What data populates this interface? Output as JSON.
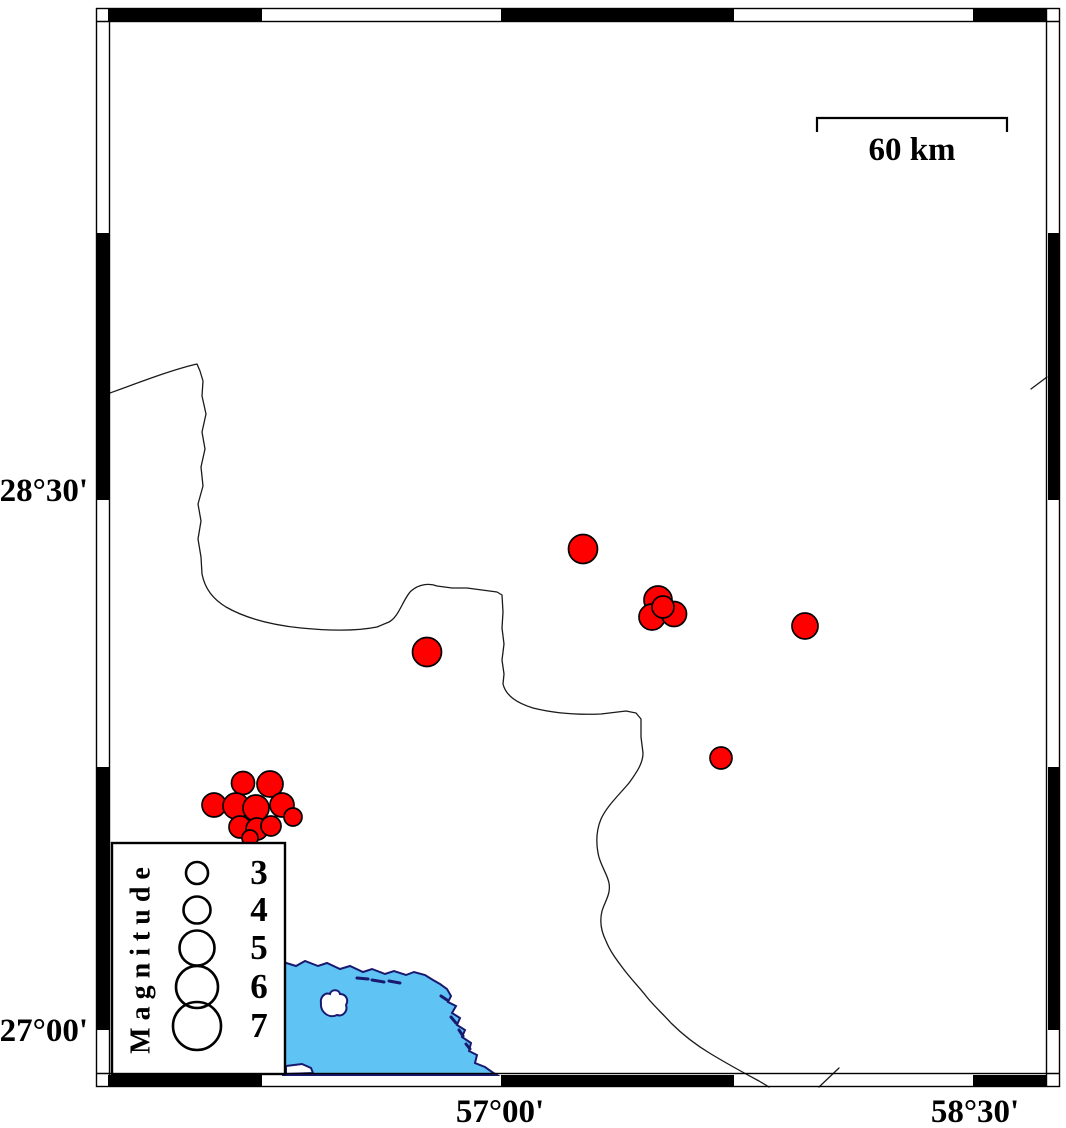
{
  "axes": {
    "left": [
      {
        "label": "28°30'"
      },
      {
        "label": "27°00'"
      }
    ],
    "bottom": [
      {
        "label": "57°00'"
      },
      {
        "label": "58°30'"
      }
    ]
  },
  "scale_bar": {
    "label": "60 km"
  },
  "legend": {
    "title": "Magnitude",
    "entries": [
      {
        "label": "3",
        "r": 11,
        "cy": 873
      },
      {
        "label": "4",
        "r": 13.5,
        "cy": 910
      },
      {
        "label": "5",
        "r": 17.5,
        "cy": 948
      },
      {
        "label": "6",
        "r": 21,
        "cy": 987
      },
      {
        "label": "7",
        "r": 24,
        "cy": 1026
      }
    ]
  },
  "colors": {
    "quake_fill": "#ff0000",
    "sea_fill": "#5fc3f4",
    "coast": "#191970",
    "frame": "#000000"
  },
  "earthquakes": [
    {
      "x": 583,
      "y": 549,
      "r": 14.5
    },
    {
      "x": 427,
      "y": 652,
      "r": 14.5
    },
    {
      "x": 805,
      "y": 626,
      "r": 13
    },
    {
      "x": 721,
      "y": 758,
      "r": 11
    },
    {
      "x": 658,
      "y": 600,
      "r": 14
    },
    {
      "x": 652,
      "y": 617,
      "r": 13
    },
    {
      "x": 674,
      "y": 614,
      "r": 12.5
    },
    {
      "x": 663,
      "y": 607,
      "r": 11
    },
    {
      "x": 243,
      "y": 783,
      "r": 11.5
    },
    {
      "x": 270,
      "y": 784,
      "r": 13
    },
    {
      "x": 214,
      "y": 805,
      "r": 12
    },
    {
      "x": 236,
      "y": 806,
      "r": 13
    },
    {
      "x": 256,
      "y": 808,
      "r": 13
    },
    {
      "x": 282,
      "y": 805,
      "r": 12
    },
    {
      "x": 293,
      "y": 817,
      "r": 9
    },
    {
      "x": 240,
      "y": 827,
      "r": 11
    },
    {
      "x": 257,
      "y": 829,
      "r": 11
    },
    {
      "x": 271,
      "y": 826,
      "r": 10
    },
    {
      "x": 250,
      "y": 838,
      "r": 8
    }
  ]
}
